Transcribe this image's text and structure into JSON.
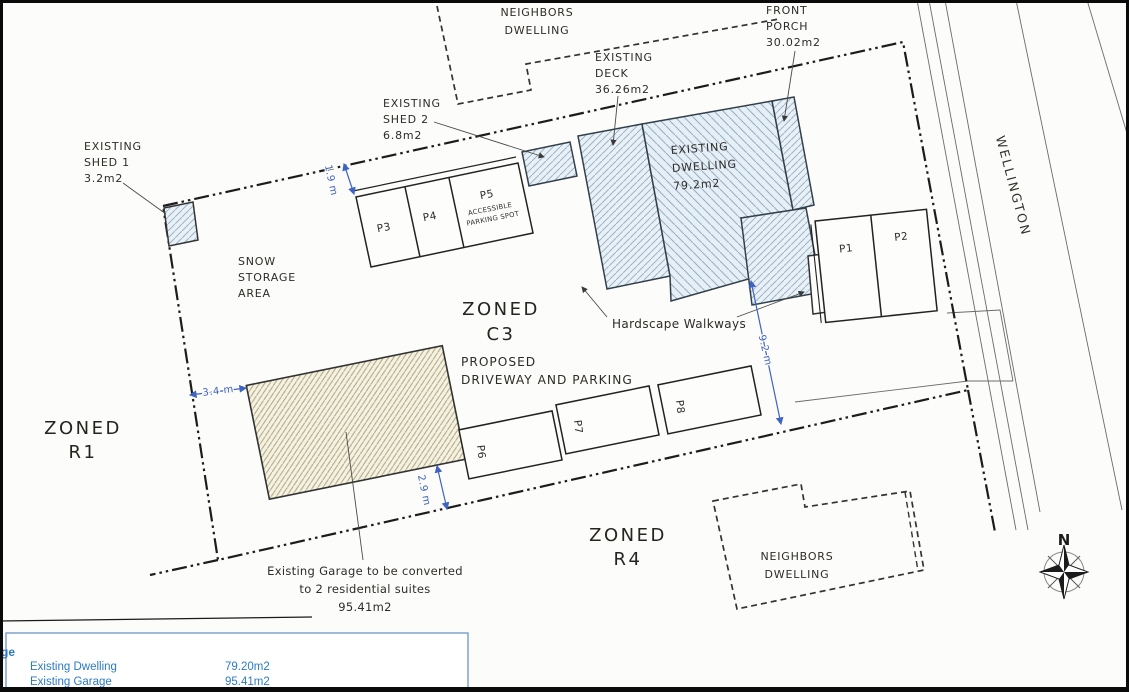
{
  "document": {
    "type": "scanned site plan drawing",
    "street_name": "WELLINGTON"
  },
  "labels": {
    "neighbors_top": [
      "NEIGHBORS",
      "DWELLING"
    ],
    "front_porch": [
      "FRONT",
      "PORCH",
      "30.02m2"
    ],
    "existing_deck": [
      "EXISTING",
      "DECK",
      "36.26m2"
    ],
    "existing_shed2": [
      "EXISTING",
      "SHED 2",
      "6.8m2"
    ],
    "existing_shed1": [
      "EXISTING",
      "SHED 1",
      "3.2m2"
    ],
    "snow_storage": [
      "SNOW",
      "STORAGE",
      "AREA"
    ],
    "existing_dwelling": [
      "EXISTING",
      "DWELLING",
      "79.2m2"
    ],
    "hardscape": "Hardscape Walkways",
    "zoned_r1": [
      "ZONED",
      "R1"
    ],
    "zoned_c3": [
      "ZONED",
      "C3"
    ],
    "zoned_r4": [
      "ZONED",
      "R4"
    ],
    "proposed_driveway": [
      "PROPOSED",
      "DRIVEWAY AND PARKING"
    ],
    "garage_note": [
      "Existing Garage to be converted",
      "to 2 residential suites",
      "95.41m2"
    ],
    "neighbors_bottom": [
      "NEIGHBORS",
      "DWELLING"
    ],
    "street_name": "WELLINGTON",
    "compass_north": "N"
  },
  "parking": {
    "p1": "P1",
    "p2": "P2",
    "p3": "P3",
    "p4": "P4",
    "p5": "P5",
    "p5_note": [
      "ACCESSIBLE",
      "PARKING SPOT"
    ],
    "p6": "P6",
    "p7": "P7",
    "p8": "P8"
  },
  "dimensions": {
    "shed_gap": "1.9 m",
    "garage_west": "3.4 m",
    "garage_south": "2.9 m",
    "driveway_east": "9.2 m"
  },
  "legend": {
    "header_fragment": "ge",
    "rows": [
      {
        "name": "Existing Dwelling",
        "area": "79.20m2"
      },
      {
        "name": "Existing Garage",
        "area": "95.41m2"
      }
    ]
  },
  "colors": {
    "dimension_blue": "#3f63c0",
    "legend_blue": "#2b7bc4",
    "dwelling_fill": "#e8f0f6",
    "dwelling_hatch": "#97b1c5",
    "garage_fill": "#f6f2df",
    "garage_hatch": "#aaa78a",
    "line_black": "#2b2b2b"
  }
}
